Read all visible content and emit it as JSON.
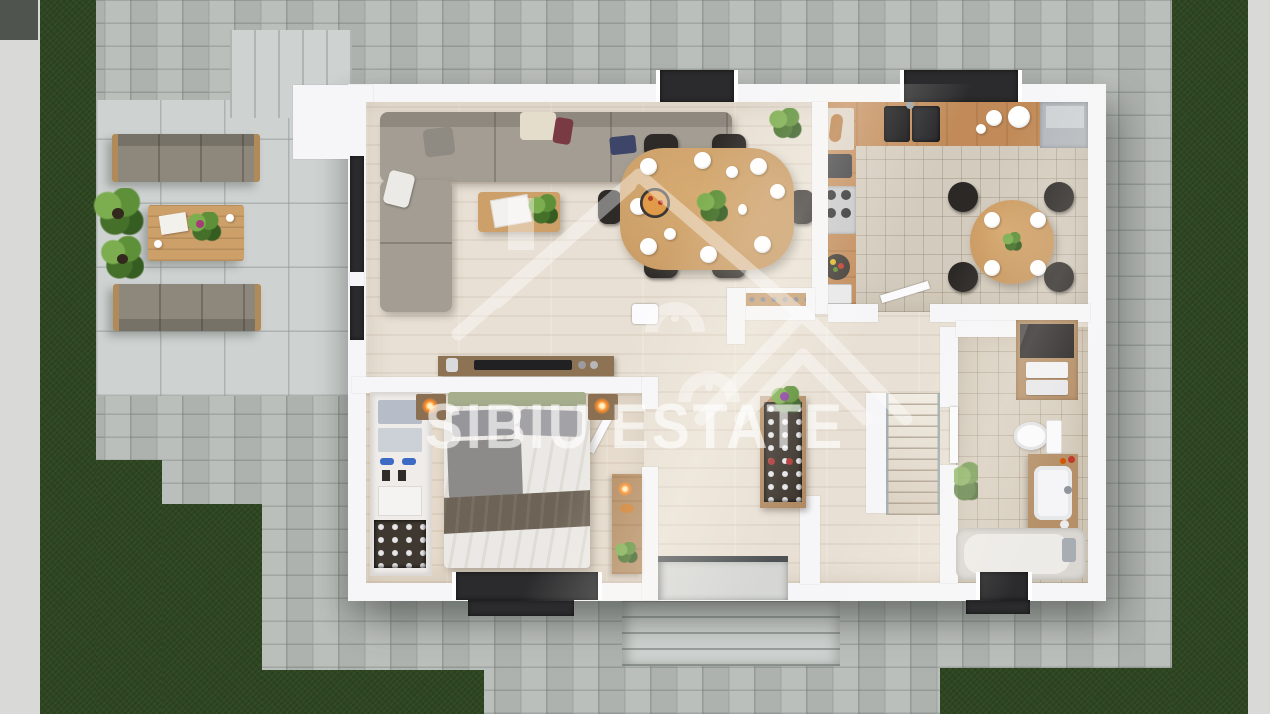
{
  "watermark": {
    "brand": "SIBIU ESTATE",
    "logo_icon": "house-roof-icon"
  },
  "palette": {
    "grass": "#2d4520",
    "sidewalk": "#d9dad8",
    "cobble": "#b6bab7",
    "joint": "#8f9692",
    "terrace": "#ced2d1",
    "wall": "#f6f6f8",
    "wooda": "#e8e0d4",
    "woodb": "#e4d9ca",
    "tilek": "#d3cbbd",
    "tileb": "#d8cfc0",
    "counter": "#c18a58",
    "dwood": "#cda06a",
    "sofa": "#a39d93",
    "ocushion": "#8e887c",
    "owood": "#b08a58",
    "windark": "#2b2b2d",
    "lamp": "#ff8e2a",
    "shelfwood": "#b59068",
    "plantg": "#4e7d33"
  }
}
